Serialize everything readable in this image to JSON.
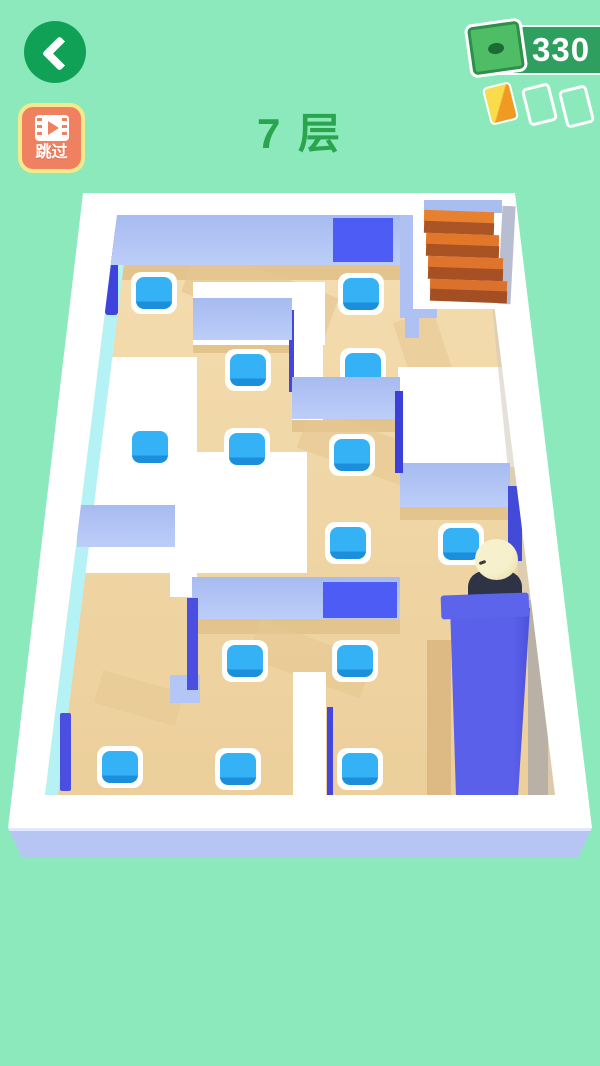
{
  "hud": {
    "skip_label": "跳过",
    "floor_label": "7 层",
    "money": "330"
  },
  "palette": {
    "bg": "#8be9bb",
    "title_green": "#2aa44d",
    "btn_green": "#10a156",
    "pill_green": "#2f9f5f",
    "skip_bg": "#ef8161",
    "skip_border": "#f6e98c",
    "bill_green": "#4fbd66",
    "bill_border": "#2e8f4b",
    "bill_dark": "#1d6b34",
    "card_orange_light": "#f9dc49",
    "card_orange_dark": "#f09a24",
    "platform_white": "#ffffff",
    "platform_front": "#b7c5f4",
    "floor_tan": "#f1d8a6",
    "wall_light": "#aec1f2",
    "wall_painted": "#4d5cf4",
    "tile_blue": "#2fa9f3",
    "stairs_orange": "#e2762a",
    "character_head": "#f3ebc2",
    "character_body": "#2e3346"
  },
  "scene": {
    "floor_offset": {
      "x": 45,
      "y": 215
    },
    "floor_elements": [
      {
        "name": "floor-base",
        "x": 0,
        "y": 0,
        "w": 510,
        "h": 580,
        "grad": "linear-gradient(180deg,#f4ddb0,#eccf9b)",
        "z": 1
      },
      {
        "name": "floor-shadow-top",
        "x": 60,
        "y": 50,
        "w": 332,
        "h": 15,
        "c": "#e4c48d",
        "z": 11
      },
      {
        "name": "floor-shadow-diag-1",
        "x": 140,
        "y": 56,
        "w": 150,
        "h": 48,
        "c": "#e6c892",
        "z": 11,
        "rot": 20,
        "op": 0.7
      },
      {
        "name": "floor-shadow-mid-left",
        "x": 148,
        "y": 125,
        "w": 99,
        "h": 13,
        "c": "#e4c48d",
        "z": 11
      },
      {
        "name": "floor-shadow-center",
        "x": 247,
        "y": 204,
        "w": 108,
        "h": 13,
        "c": "#e4c48d",
        "z": 11
      },
      {
        "name": "floor-shadow-diag-2",
        "x": 255,
        "y": 214,
        "w": 130,
        "h": 42,
        "c": "#e6c892",
        "z": 11,
        "rot": 20,
        "op": 0.65
      },
      {
        "name": "floor-shadow-right",
        "x": 355,
        "y": 292,
        "w": 110,
        "h": 13,
        "c": "#e4c48d",
        "z": 11
      },
      {
        "name": "floor-shadow-left",
        "x": 32,
        "y": 332,
        "w": 98,
        "h": 13,
        "c": "#e4c48d",
        "z": 11
      },
      {
        "name": "floor-shadow-lower",
        "x": 147,
        "y": 404,
        "w": 208,
        "h": 15,
        "c": "#e4c48d",
        "z": 11
      },
      {
        "name": "floor-shadow-diag-3",
        "x": 205,
        "y": 424,
        "w": 120,
        "h": 40,
        "c": "#e6c892",
        "z": 11,
        "rot": 20,
        "op": 0.65
      },
      {
        "name": "floor-shadow-diag-4",
        "x": 52,
        "y": 466,
        "w": 84,
        "h": 34,
        "c": "#e6c892",
        "z": 11,
        "rot": 16,
        "op": 0.6
      },
      {
        "name": "floor-shadow-stairs",
        "x": 357,
        "y": 100,
        "w": 42,
        "h": 64,
        "c": "#e6c892",
        "z": 11,
        "rot": -18,
        "op": 0.6
      },
      {
        "name": "floor-shadow-elevator-left",
        "x": 382,
        "y": 425,
        "w": 24,
        "h": 155,
        "c": "#ddba83",
        "z": 11
      },
      {
        "name": "path-white-1",
        "x": 148,
        "y": 67,
        "w": 132,
        "h": 63,
        "c": "#ffffff",
        "z": 12
      },
      {
        "name": "path-white-2",
        "x": 247,
        "y": 88,
        "w": 31,
        "h": 117,
        "c": "#ffffff",
        "z": 12
      },
      {
        "name": "path-white-3",
        "x": 353,
        "y": 152,
        "w": 119,
        "h": 100,
        "c": "#ffffff",
        "z": 12
      },
      {
        "name": "path-white-4",
        "x": 43,
        "y": 142,
        "w": 109,
        "h": 95,
        "c": "#ffffff",
        "z": 12
      },
      {
        "name": "path-white-5",
        "x": 15,
        "y": 237,
        "w": 247,
        "h": 121,
        "c": "#ffffff",
        "z": 12
      },
      {
        "name": "path-white-6",
        "x": 125,
        "y": 330,
        "w": 27,
        "h": 52,
        "c": "#ffffff",
        "z": 12
      },
      {
        "name": "path-white-7",
        "x": 248,
        "y": 457,
        "w": 33,
        "h": 123,
        "c": "#ffffff",
        "z": 12
      },
      {
        "name": "left-rim-inner-face",
        "x": 0,
        "y": 0,
        "w": 86,
        "h": 580,
        "clip": "polygon(72px 0px,85px 0px,13px 580px,0px 580px)",
        "c": "#b5f2f6",
        "z": 14
      },
      {
        "name": "right-rim-inner-face",
        "x": 438,
        "y": 0,
        "w": 72,
        "h": 580,
        "clip": "polygon(0px 0px,15px 0px,72px 580px,57px 580px)",
        "c": "#cfc6ba",
        "z": 14,
        "op": 0.55
      },
      {
        "name": "wall-side-navy-topleft",
        "x": 60,
        "y": 14,
        "w": 13,
        "h": 86,
        "c": "#3f43dd",
        "z": 15,
        "r": 3
      },
      {
        "name": "wall-side-navy-corridor",
        "x": 244,
        "y": 95,
        "w": 5,
        "h": 82,
        "c": "#4347e0",
        "z": 15
      },
      {
        "name": "wall-side-navy-bottomleft",
        "x": 15,
        "y": 498,
        "w": 11,
        "h": 78,
        "c": "#4a4fe2",
        "z": 15,
        "r": 2
      },
      {
        "name": "wall-side-navy-bottommid",
        "x": 282,
        "y": 492,
        "w": 6,
        "h": 88,
        "c": "#4347e0",
        "z": 15
      },
      {
        "name": "tile-pad",
        "x": 86,
        "y": 57,
        "w": 46,
        "h": 42,
        "c": "#ffffff",
        "r": 10,
        "z": 20
      },
      {
        "name": "tile-pad",
        "x": 293,
        "y": 58,
        "w": 46,
        "h": 42,
        "c": "#ffffff",
        "r": 10,
        "z": 20
      },
      {
        "name": "tile-pad",
        "x": 180,
        "y": 134,
        "w": 46,
        "h": 42,
        "c": "#ffffff",
        "r": 10,
        "z": 20
      },
      {
        "name": "tile-pad",
        "x": 295,
        "y": 133,
        "w": 46,
        "h": 42,
        "c": "#ffffff",
        "r": 10,
        "z": 20
      },
      {
        "name": "tile-pad",
        "x": 82,
        "y": 211,
        "w": 46,
        "h": 42,
        "c": "#ffffff",
        "r": 10,
        "z": 20
      },
      {
        "name": "tile-pad",
        "x": 179,
        "y": 213,
        "w": 46,
        "h": 42,
        "c": "#ffffff",
        "r": 10,
        "z": 20
      },
      {
        "name": "tile-pad",
        "x": 284,
        "y": 219,
        "w": 46,
        "h": 42,
        "c": "#ffffff",
        "r": 10,
        "z": 20
      },
      {
        "name": "tile-pad",
        "x": 280,
        "y": 307,
        "w": 46,
        "h": 42,
        "c": "#ffffff",
        "r": 10,
        "z": 20
      },
      {
        "name": "tile-pad",
        "x": 393,
        "y": 308,
        "w": 46,
        "h": 42,
        "c": "#ffffff",
        "r": 10,
        "z": 20
      },
      {
        "name": "tile-pad",
        "x": 177,
        "y": 425,
        "w": 46,
        "h": 42,
        "c": "#ffffff",
        "r": 10,
        "z": 20
      },
      {
        "name": "tile-pad",
        "x": 287,
        "y": 425,
        "w": 46,
        "h": 42,
        "c": "#ffffff",
        "r": 10,
        "z": 20
      },
      {
        "name": "tile-pad",
        "x": 52,
        "y": 531,
        "w": 46,
        "h": 42,
        "c": "#ffffff",
        "r": 10,
        "z": 20
      },
      {
        "name": "tile-pad",
        "x": 170,
        "y": 533,
        "w": 46,
        "h": 42,
        "c": "#ffffff",
        "r": 10,
        "z": 20
      },
      {
        "name": "tile-pad",
        "x": 292,
        "y": 533,
        "w": 46,
        "h": 42,
        "c": "#ffffff",
        "r": 10,
        "z": 20
      },
      {
        "name": "tile",
        "x": 91,
        "y": 62,
        "w": 36,
        "h": 32,
        "grad": "linear-gradient(180deg,#35b2f6 76%,#1b8fdc 77%)",
        "r": 8,
        "z": 22
      },
      {
        "name": "tile",
        "x": 298,
        "y": 63,
        "w": 36,
        "h": 32,
        "grad": "linear-gradient(180deg,#35b2f6 76%,#1b8fdc 77%)",
        "r": 8,
        "z": 22
      },
      {
        "name": "tile",
        "x": 185,
        "y": 139,
        "w": 36,
        "h": 32,
        "grad": "linear-gradient(180deg,#35b2f6 76%,#1b8fdc 77%)",
        "r": 8,
        "z": 22
      },
      {
        "name": "tile",
        "x": 300,
        "y": 138,
        "w": 36,
        "h": 32,
        "grad": "linear-gradient(180deg,#35b2f6 76%,#1b8fdc 77%)",
        "r": 8,
        "z": 22
      },
      {
        "name": "tile",
        "x": 87,
        "y": 216,
        "w": 36,
        "h": 32,
        "grad": "linear-gradient(180deg,#35b2f6 76%,#1b8fdc 77%)",
        "r": 8,
        "z": 22
      },
      {
        "name": "tile",
        "x": 184,
        "y": 218,
        "w": 36,
        "h": 32,
        "grad": "linear-gradient(180deg,#35b2f6 76%,#1b8fdc 77%)",
        "r": 8,
        "z": 22
      },
      {
        "name": "tile",
        "x": 289,
        "y": 224,
        "w": 36,
        "h": 32,
        "grad": "linear-gradient(180deg,#35b2f6 76%,#1b8fdc 77%)",
        "r": 8,
        "z": 22
      },
      {
        "name": "tile",
        "x": 285,
        "y": 312,
        "w": 36,
        "h": 32,
        "grad": "linear-gradient(180deg,#35b2f6 76%,#1b8fdc 77%)",
        "r": 8,
        "z": 22
      },
      {
        "name": "tile",
        "x": 398,
        "y": 313,
        "w": 36,
        "h": 32,
        "grad": "linear-gradient(180deg,#35b2f6 76%,#1b8fdc 77%)",
        "r": 8,
        "z": 22
      },
      {
        "name": "tile",
        "x": 182,
        "y": 430,
        "w": 36,
        "h": 32,
        "grad": "linear-gradient(180deg,#35b2f6 76%,#1b8fdc 77%)",
        "r": 8,
        "z": 22
      },
      {
        "name": "tile",
        "x": 292,
        "y": 430,
        "w": 36,
        "h": 32,
        "grad": "linear-gradient(180deg,#35b2f6 76%,#1b8fdc 77%)",
        "r": 8,
        "z": 22
      },
      {
        "name": "tile",
        "x": 57,
        "y": 536,
        "w": 36,
        "h": 32,
        "grad": "linear-gradient(180deg,#35b2f6 76%,#1b8fdc 77%)",
        "r": 8,
        "z": 22
      },
      {
        "name": "tile",
        "x": 175,
        "y": 538,
        "w": 36,
        "h": 32,
        "grad": "linear-gradient(180deg,#35b2f6 76%,#1b8fdc 77%)",
        "r": 8,
        "z": 22
      },
      {
        "name": "tile",
        "x": 297,
        "y": 538,
        "w": 36,
        "h": 32,
        "grad": "linear-gradient(180deg,#35b2f6 76%,#1b8fdc 77%)",
        "r": 8,
        "z": 22
      },
      {
        "name": "wall-top",
        "x": 60,
        "y": 0,
        "w": 295,
        "h": 50,
        "grad": "linear-gradient(180deg,#a7bbf0,#bccdf8)",
        "z": 30
      },
      {
        "name": "wall-top-painted",
        "x": 288,
        "y": 3,
        "w": 60,
        "h": 44,
        "c": "#4d5cf4",
        "z": 31
      },
      {
        "name": "wall-top-right",
        "x": 355,
        "y": 0,
        "w": 37,
        "h": 103,
        "c": "#aec1f2",
        "z": 30
      },
      {
        "name": "wall-stub",
        "x": 360,
        "y": 85,
        "w": 14,
        "h": 38,
        "c": "#aec1f2",
        "z": 30
      },
      {
        "name": "wall-mid-left",
        "x": 148,
        "y": 83,
        "w": 99,
        "h": 42,
        "grad": "linear-gradient(180deg,#a7bbf0,#bccdf8)",
        "z": 30
      },
      {
        "name": "wall-center",
        "x": 247,
        "y": 162,
        "w": 108,
        "h": 42,
        "grad": "linear-gradient(180deg,#a7bbf0,#bccdf8)",
        "z": 30
      },
      {
        "name": "wall-center-side-navy",
        "x": 350,
        "y": 176,
        "w": 8,
        "h": 82,
        "c": "#3c40d8",
        "z": 31
      },
      {
        "name": "wall-right",
        "x": 355,
        "y": 248,
        "w": 110,
        "h": 44,
        "grad": "linear-gradient(180deg,#a7bbf0,#bccdf8)",
        "z": 30
      },
      {
        "name": "wall-right-side-navy",
        "x": 463,
        "y": 271,
        "w": 14,
        "h": 75,
        "c": "#444ad8",
        "z": 31
      },
      {
        "name": "wall-left",
        "x": 32,
        "y": 290,
        "w": 98,
        "h": 42,
        "grad": "linear-gradient(180deg,#a7bbf0,#bccdf8)",
        "z": 30
      },
      {
        "name": "wall-lower",
        "x": 147,
        "y": 362,
        "w": 208,
        "h": 42,
        "grad": "linear-gradient(180deg,#a7bbf0,#bccdf8)",
        "z": 30
      },
      {
        "name": "wall-lower-painted",
        "x": 278,
        "y": 367,
        "w": 74,
        "h": 36,
        "c": "#4d5cf4",
        "z": 31
      },
      {
        "name": "wall-lower-side-navy",
        "x": 142,
        "y": 383,
        "w": 11,
        "h": 92,
        "c": "#4a4fe2",
        "z": 31
      },
      {
        "name": "wall-lower-foot",
        "x": 125,
        "y": 460,
        "w": 30,
        "h": 28,
        "c": "#b3c6f5",
        "z": 30
      },
      {
        "name": "right-gray-strip",
        "x": 483,
        "y": 385,
        "w": 20,
        "h": 195,
        "c": "#b9b1a6",
        "z": 36
      },
      {
        "name": "character-body",
        "x": 423,
        "y": 356,
        "w": 54,
        "h": 42,
        "c": "#2e3346",
        "r": "16px 16px 10px 10px",
        "z": 42
      },
      {
        "name": "character-head",
        "x": 430,
        "y": 324,
        "w": 43,
        "h": 41,
        "grad": "radial-gradient(circle at 35% 30%,#f7f0cd 55%,#e5d8a3)",
        "r": "50%",
        "z": 43
      },
      {
        "name": "character-eyebrow",
        "x": 434,
        "y": 346,
        "w": 7,
        "h": 3,
        "c": "#3a3a3a",
        "r": 2,
        "rot": -20,
        "z": 44
      },
      {
        "name": "elevator-column",
        "x": 395,
        "y": 383,
        "w": 92,
        "h": 199,
        "grad": "linear-gradient(90deg,#5a60ea 80%,#4a4fd8)",
        "clip": "polygon(10px 6px,90px 10px,78px 199px,16px 199px)",
        "z": 45
      },
      {
        "name": "elevator-top-lip",
        "x": 396,
        "y": 379,
        "w": 88,
        "h": 24,
        "c": "#5d64ec",
        "rot": -2,
        "r": 3,
        "z": 46
      }
    ],
    "overlay_elements": [
      {
        "name": "stairs-alcove",
        "x": 413,
        "y": 199,
        "w": 99,
        "h": 110,
        "c": "#ffffff",
        "z": 6
      },
      {
        "name": "stairs-back-wall",
        "x": 424,
        "y": 200,
        "w": 78,
        "h": 13,
        "c": "#a9bef0",
        "z": 7
      },
      {
        "name": "stairs-shade-right",
        "x": 500,
        "y": 206,
        "w": 13,
        "h": 98,
        "c": "#b9bdd2",
        "rot": 3,
        "z": 7
      },
      {
        "name": "stair-step-top-1",
        "x": 424,
        "y": 211,
        "w": 70,
        "h": 12,
        "c": "#e8812f",
        "rot": 2,
        "z": 8
      },
      {
        "name": "stair-step-front-1",
        "x": 424,
        "y": 222,
        "w": 70,
        "h": 12,
        "c": "#ab5526",
        "rot": 2,
        "z": 8
      },
      {
        "name": "stair-step-top-2",
        "x": 426,
        "y": 234,
        "w": 73,
        "h": 12,
        "c": "#e37729",
        "rot": 2,
        "z": 8
      },
      {
        "name": "stair-step-front-2",
        "x": 426,
        "y": 245,
        "w": 73,
        "h": 12,
        "c": "#a95224",
        "rot": 2,
        "z": 8
      },
      {
        "name": "stair-step-top-3",
        "x": 428,
        "y": 257,
        "w": 75,
        "h": 12,
        "c": "#df752c",
        "rot": 2,
        "z": 8
      },
      {
        "name": "stair-step-front-3",
        "x": 428,
        "y": 268,
        "w": 75,
        "h": 12,
        "c": "#a75023",
        "rot": 2,
        "z": 8
      },
      {
        "name": "stair-step-top-4",
        "x": 430,
        "y": 280,
        "w": 77,
        "h": 11,
        "c": "#da722e",
        "rot": 2,
        "z": 8
      },
      {
        "name": "stair-step-front-4",
        "x": 430,
        "y": 290,
        "w": 77,
        "h": 12,
        "c": "#a44e23",
        "rot": 2,
        "z": 8
      }
    ]
  }
}
